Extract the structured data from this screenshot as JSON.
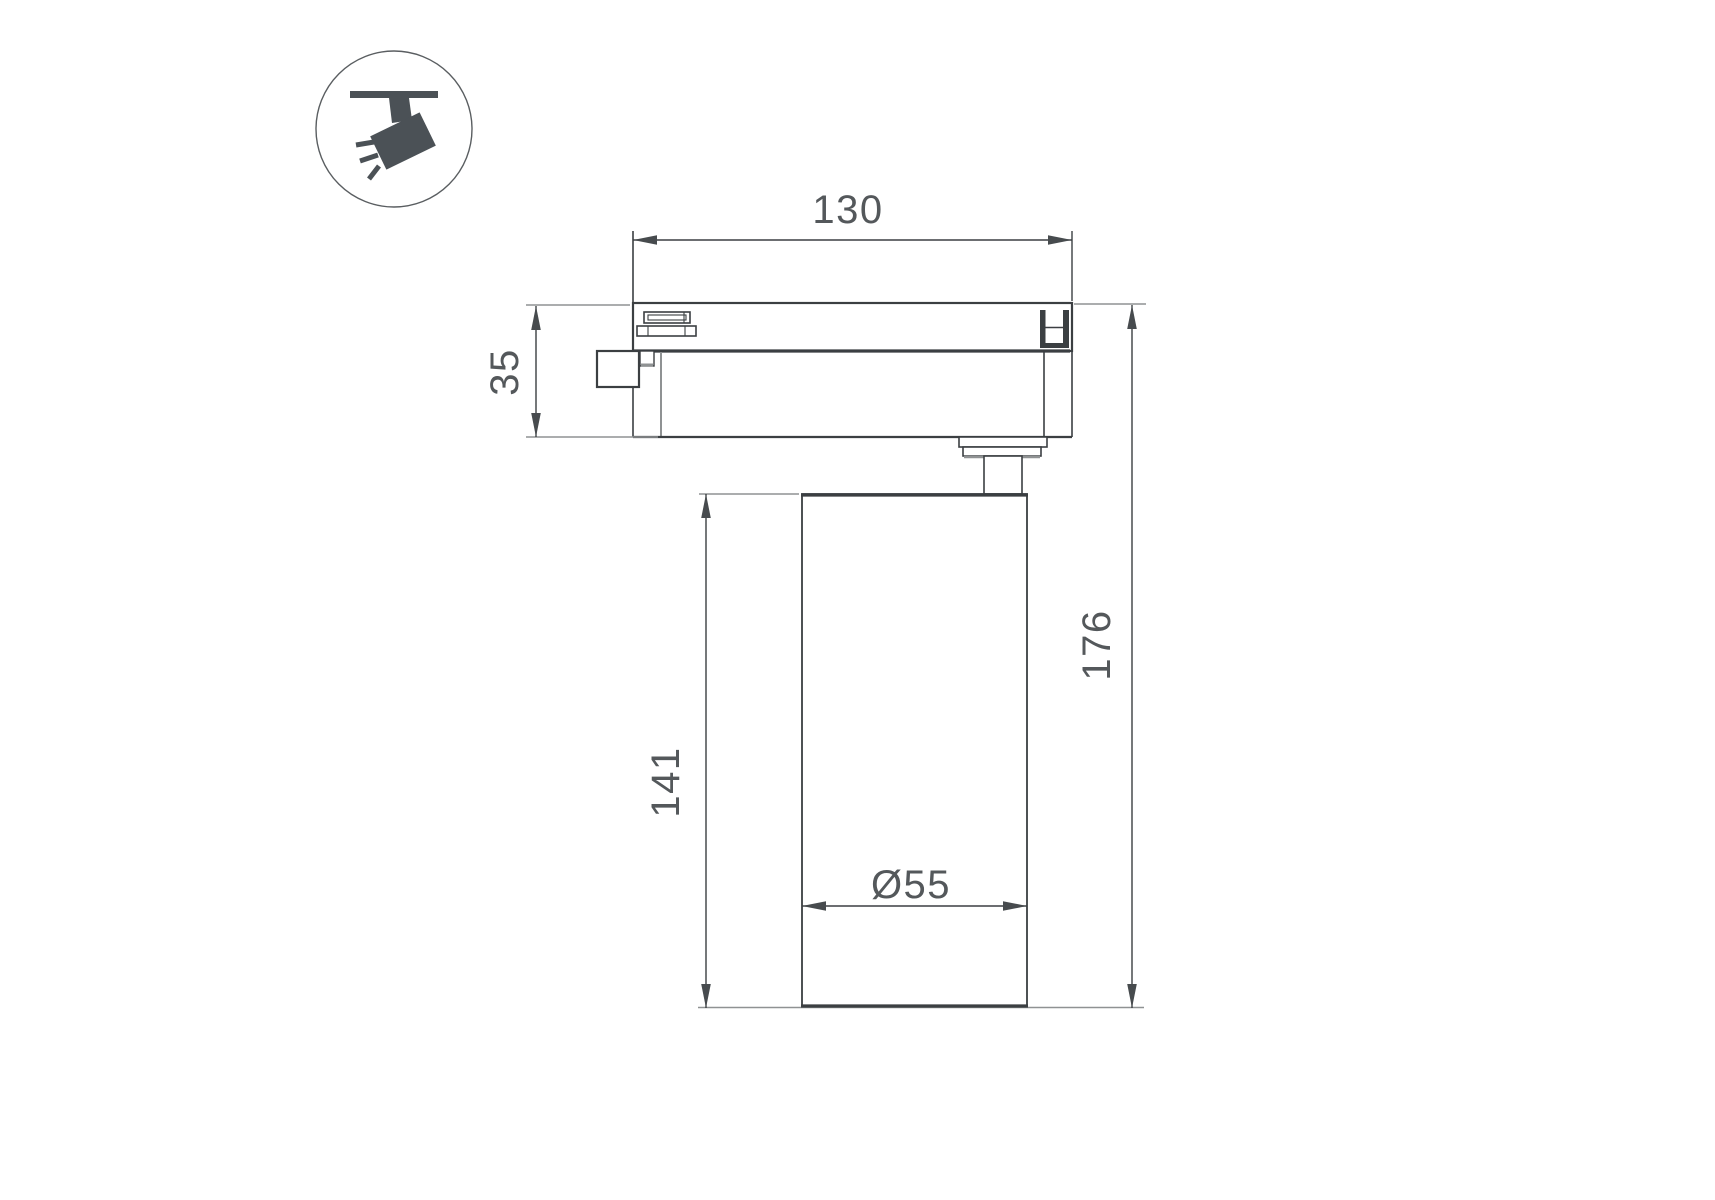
{
  "colors": {
    "background": "#ffffff",
    "line_dark": "#3b3f42",
    "line_gray": "#8f9293",
    "arrow": "#474b4e",
    "text": "#54585b",
    "icon_fill": "#4b5156",
    "icon_stroke": "#5a5e61"
  },
  "icon": {
    "name": "track-spotlight-icon"
  },
  "dimensions": {
    "track_width": {
      "label": "130"
    },
    "adapter_height": {
      "label": "35"
    },
    "body_height": {
      "label": "141"
    },
    "total_height": {
      "label": "176"
    },
    "body_diameter": {
      "label": "Ø55"
    }
  }
}
